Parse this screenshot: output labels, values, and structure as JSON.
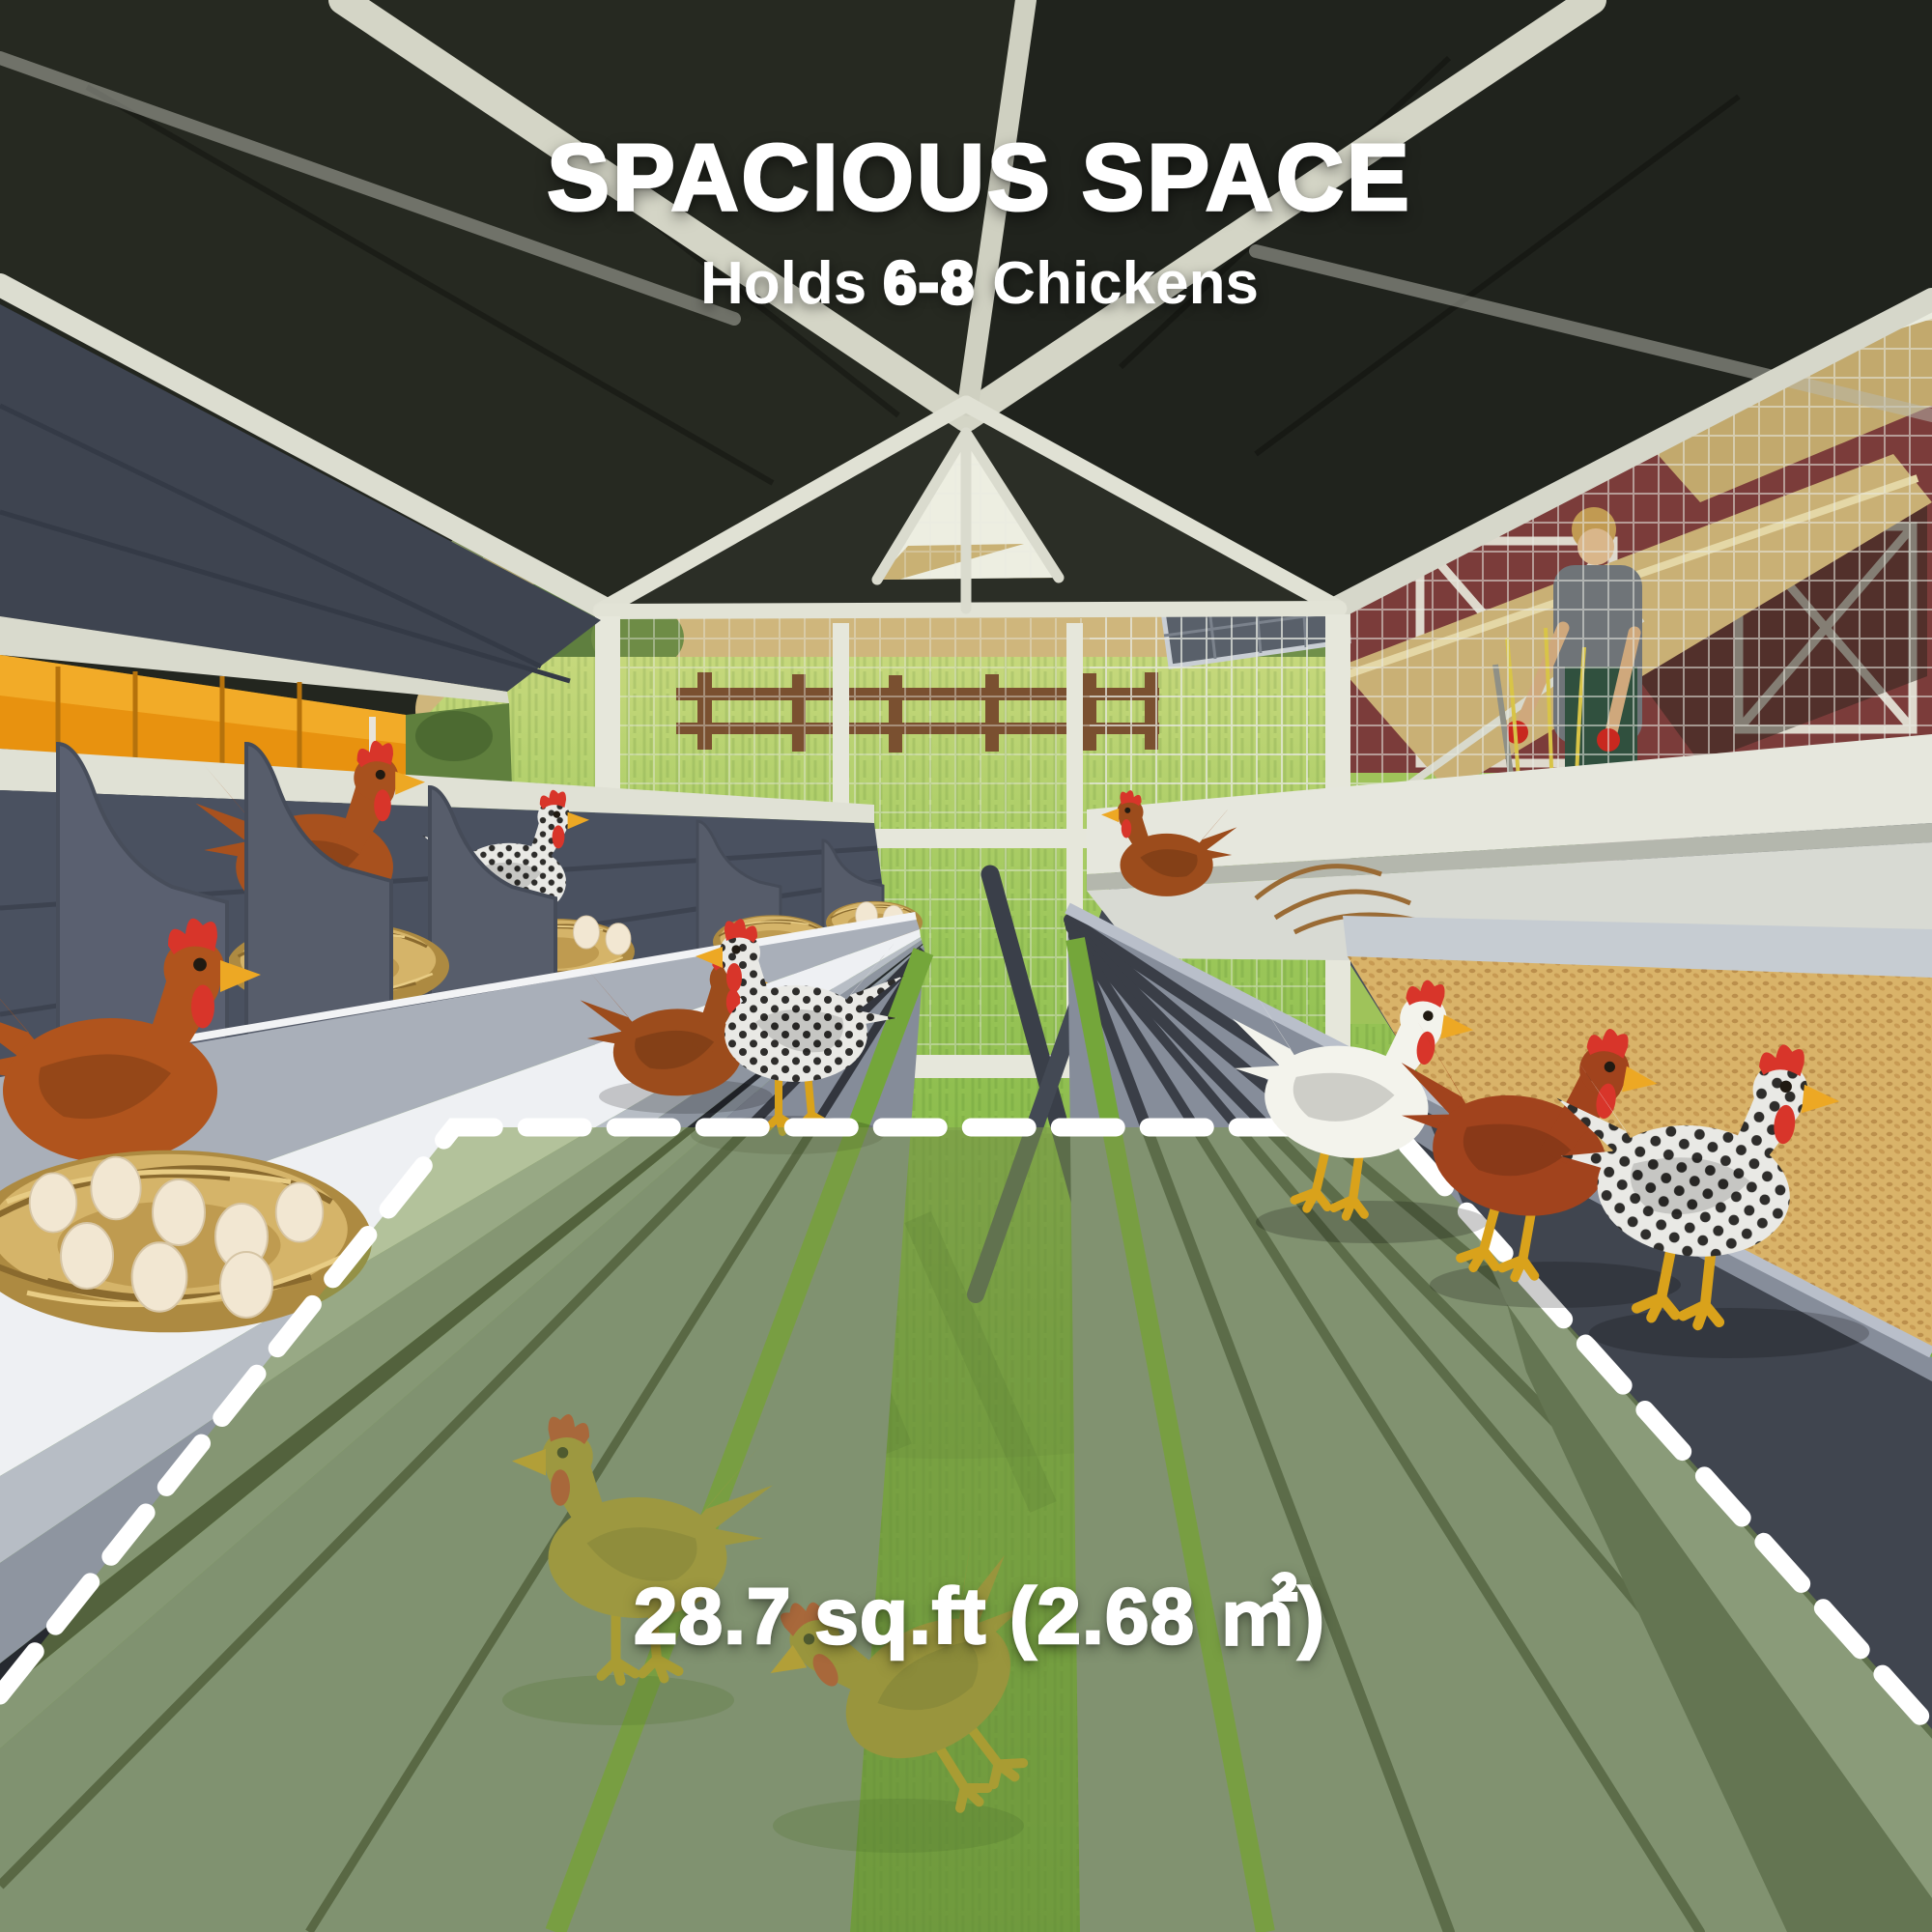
{
  "text": {
    "title": "SPACIOUS SPACE",
    "subtitle_prefix": "Holds ",
    "subtitle_highlight": "6-8",
    "subtitle_suffix": " Chickens",
    "area_label": "28.7 sq.ft (2.68 ㎡)"
  },
  "colors": {
    "text_white": "#ffffff",
    "roof_dark": "#23261f",
    "beam_white": "#dfe0d3",
    "wall_slate": "#454b57",
    "bench_gray": "#7d8593",
    "grass_green": "#7eb33e",
    "highlight_green": "#7c984a",
    "dash_outline": "#ffffff",
    "hay_tan": "#c8a458",
    "grain_tan": "#d9b369",
    "barn_red": "#7b3c3a",
    "autumn_orange": "#e8920f",
    "hen_brown": "#a8511e",
    "hen_white": "#f3f3ec",
    "hen_gold": "#c09a36",
    "comb_red": "#d8352a"
  }
}
